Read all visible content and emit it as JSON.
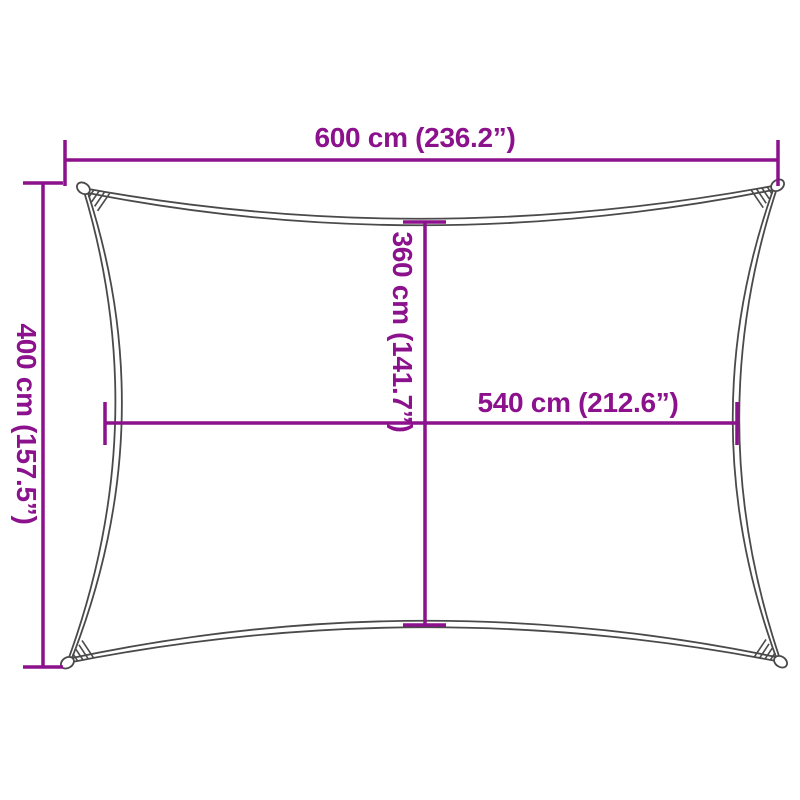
{
  "figure": {
    "type": "product-dimension-diagram",
    "subject": "rectangular-shade-sail"
  },
  "colors": {
    "accent": "#8C118C",
    "outline": "#4A4A4A",
    "background": "#FFFFFF"
  },
  "dimensions": {
    "top_width": {
      "label": "600 cm (236.2”)",
      "cm": 600,
      "inches": 236.2,
      "orientation": "horizontal"
    },
    "left_height": {
      "label": "400 cm (157.5”)",
      "cm": 400,
      "inches": 157.5,
      "orientation": "vertical"
    },
    "inner_height": {
      "label": "360 cm (141.7”)",
      "cm": 360,
      "inches": 141.7,
      "orientation": "vertical"
    },
    "inner_width": {
      "label": "540 cm (212.6”)",
      "cm": 540,
      "inches": 212.6,
      "orientation": "horizontal"
    }
  }
}
